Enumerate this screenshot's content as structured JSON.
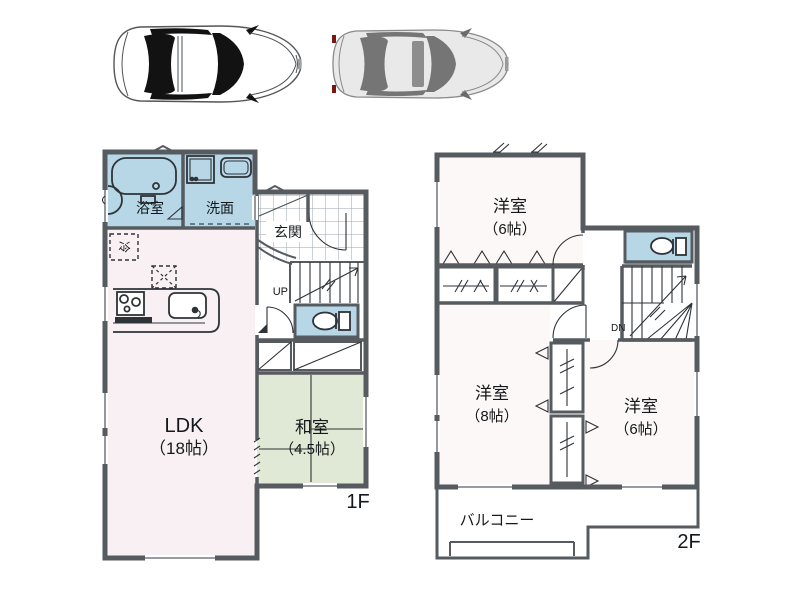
{
  "document_type": "real-estate-floor-plan",
  "cars": {
    "left": "white-sedan-top-view",
    "right": "gray-sedan-top-view"
  },
  "floor1": {
    "floor_label": "1F",
    "rooms": {
      "ldk": {
        "name": "LDK",
        "size": "（18帖）"
      },
      "washitsu": {
        "name": "和室",
        "size": "（4.5帖）"
      },
      "bathroom": {
        "label": "浴室"
      },
      "washroom": {
        "label": "洗面"
      },
      "entrance": {
        "label": "玄関"
      },
      "fridge": {
        "label": "冷"
      }
    },
    "stairs": {
      "up": "UP"
    }
  },
  "floor2": {
    "floor_label": "2F",
    "rooms": {
      "bedroom_north": {
        "name": "洋室",
        "size": "（6帖）"
      },
      "bedroom_west": {
        "name": "洋室",
        "size": "（8帖）"
      },
      "bedroom_east": {
        "name": "洋室",
        "size": "（6帖）"
      },
      "balcony": {
        "label": "バルコニー"
      }
    },
    "stairs": {
      "down": "DN"
    }
  },
  "colors": {
    "wall": "#565b60",
    "wet_area_blue": "#b7d7e7",
    "tatami_green": "#dfe9d5",
    "ldk_floor_pink": "#f8f0f3",
    "room_floor": "#fcf8f7",
    "closet_gray": "#e0e3dc",
    "line": "#2e3338"
  }
}
